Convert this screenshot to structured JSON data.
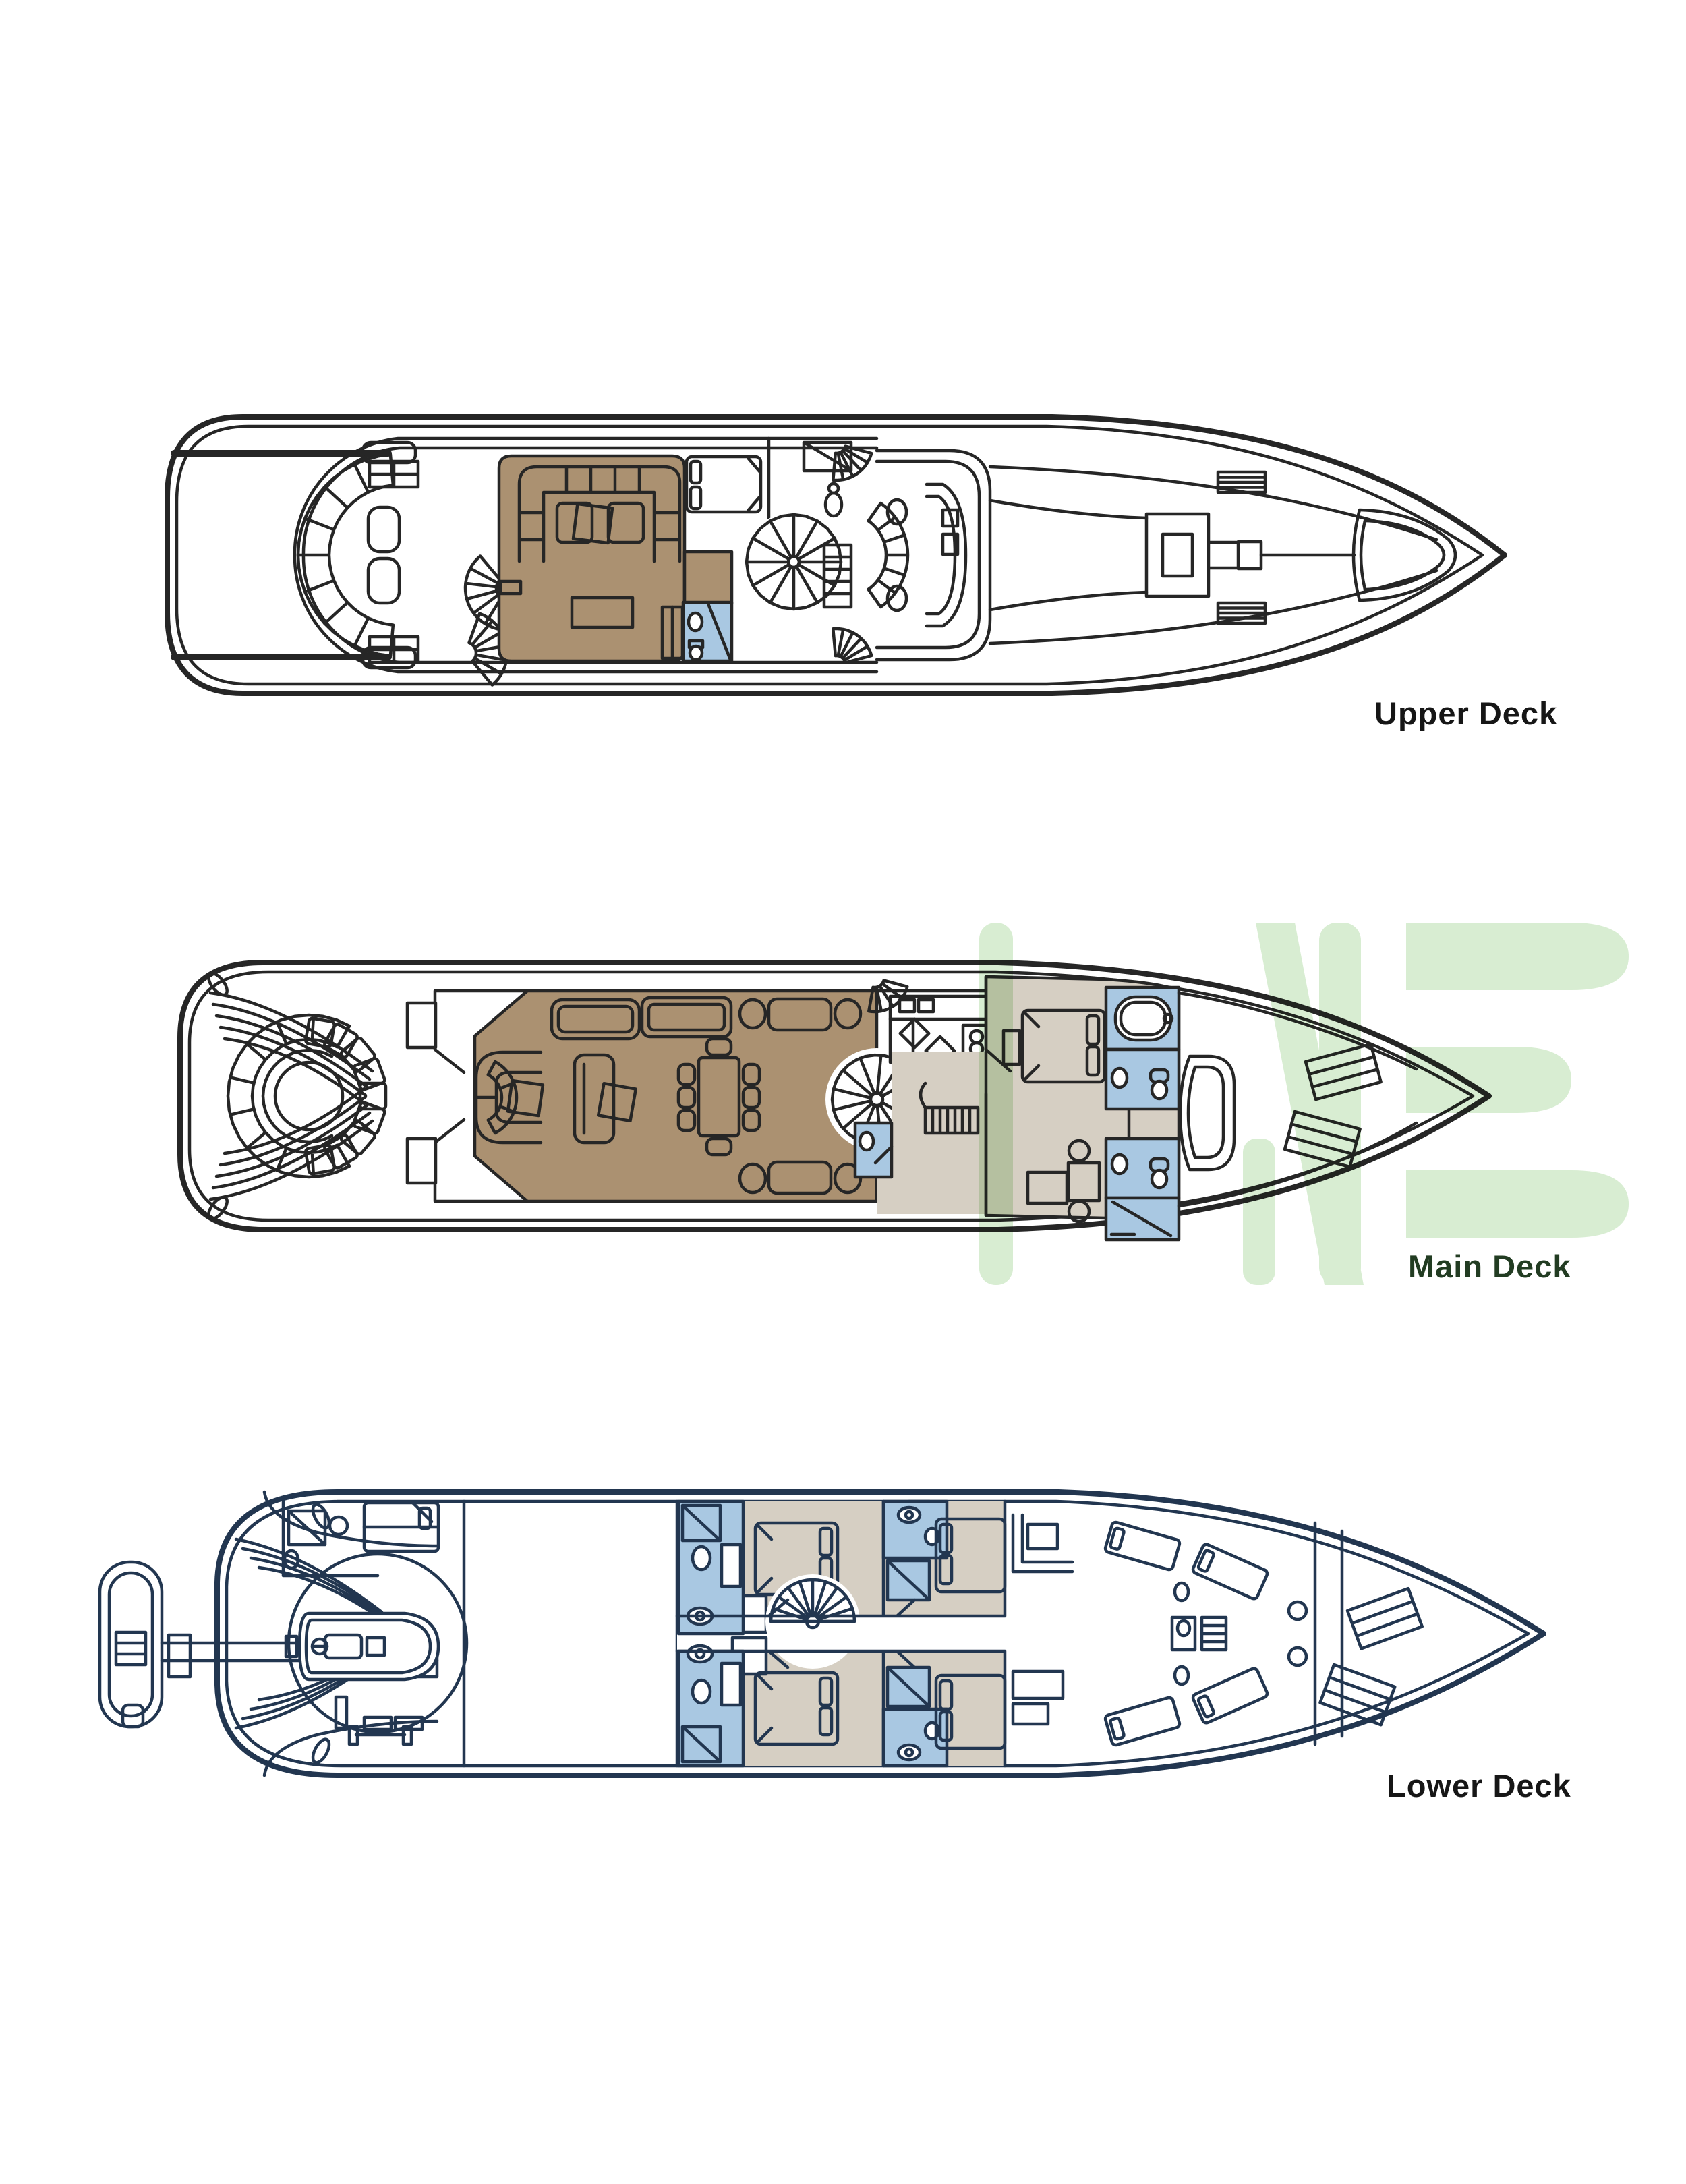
{
  "page": {
    "background": "#ffffff",
    "type": "yacht-deck-plan"
  },
  "decks": [
    {
      "id": "upper-deck",
      "label": "Upper Deck"
    },
    {
      "id": "main-deck",
      "label": "Main Deck"
    },
    {
      "id": "lower-deck",
      "label": "Lower Deck"
    }
  ],
  "watermark": {
    "letters": "ME",
    "partial_letter": "I"
  },
  "colors": {
    "line": "#262626",
    "navy": "#223650",
    "brown": "#ab9171",
    "beige": "#d6cfc3",
    "blue": "#a9c8e2",
    "green": "#d8edd2",
    "label": "#161616",
    "mainlabel": "#223c22"
  }
}
